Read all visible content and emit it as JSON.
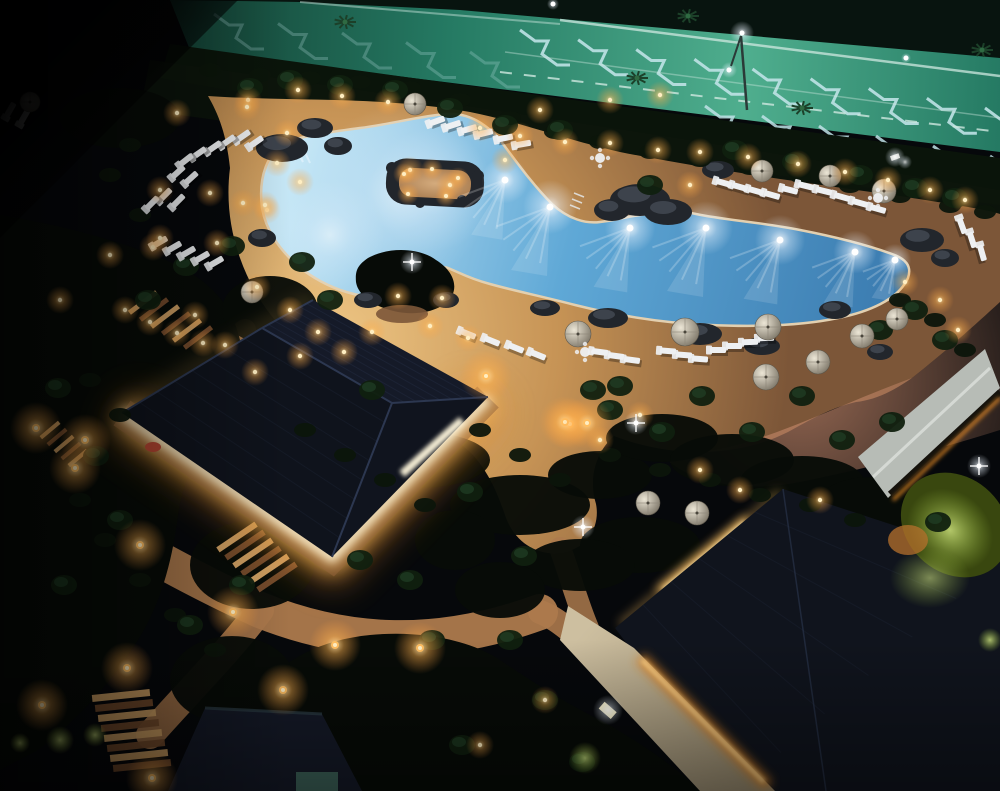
{
  "colors": {
    "night": "#06080b",
    "park_teal": "#257a63",
    "park_light": "#4fae8e",
    "park_dark": "#123c30",
    "park_road": "#08140f",
    "marking": "#bfe2e6",
    "rail": "#cfe8e0",
    "hedge": "#0a140a",
    "bush": "#0c150b",
    "tree": "#10200f",
    "tree_hi": "#23442a",
    "veg": "#070b07",
    "deck": "#c69355",
    "deck_bright": "#eec684",
    "deck_dim": "#7c5638",
    "deck_pink": "#c5886a",
    "water_deep": "#3878ad",
    "water_mid": "#5fa8d6",
    "water_pale": "#c6e7f6",
    "coping": "#e3d0b0",
    "sand": "#d4ab7d",
    "rock": "#454b55",
    "rock_dark": "#22262c",
    "roof": "#151a28",
    "roof_hi": "#1f2940",
    "roof_dark": "#10141d",
    "roof_line": "#2c3750",
    "glow_core": "#fff6d8",
    "glow_warm": "#f6bc62",
    "glow_amber": "#dd8526",
    "gravel": "#94653a",
    "path": "#ad7a4d",
    "stair_light": "#d9a868",
    "stair_dark": "#7a4f2e",
    "lamp": "#ffbe62",
    "lamp_core": "#ffeec2",
    "chair": "#eef0f2",
    "umb": "#cfc8b8",
    "umb_dark": "#7b7466",
    "walkway": "#c3b395",
    "grey_roof": "#b7bcb6",
    "green_lit": "#a9c348",
    "green_dark": "#39470f",
    "red": "#b24531",
    "white": "#ffffff"
  },
  "scene": {
    "parking": {
      "chevron_bands": [
        {
          "x0": 520,
          "y0": 30,
          "x1": 985,
          "y1": 108,
          "n": 9,
          "o": 0.9
        },
        {
          "x0": 705,
          "y0": 106,
          "x1": 990,
          "y1": 156,
          "n": 6,
          "o": 0.85
        },
        {
          "x0": 214,
          "y0": 14,
          "x1": 470,
          "y1": 52,
          "n": 5,
          "o": 0.25
        }
      ],
      "lines": [
        {
          "x1": 560,
          "y1": 20,
          "x2": 1000,
          "y2": 76,
          "w": 2.5,
          "o": 0.75,
          "dash": ""
        },
        {
          "x1": 300,
          "y1": 2,
          "x2": 560,
          "y2": 24,
          "w": 2,
          "o": 0.45,
          "dash": ""
        },
        {
          "x1": 500,
          "y1": 72,
          "x2": 1000,
          "y2": 132,
          "w": 2,
          "o": 0.8,
          "dash": "12 12"
        },
        {
          "x1": 505,
          "y1": 52,
          "x2": 1000,
          "y2": 118,
          "w": 1.5,
          "o": 0.4,
          "dash": ""
        }
      ]
    },
    "palms": [
      [
        637,
        78
      ],
      [
        802,
        108
      ],
      [
        982,
        50
      ],
      [
        345,
        22
      ],
      [
        688,
        16
      ]
    ],
    "street_lights": [
      [
        742,
        33,
        12
      ],
      [
        729,
        70,
        8
      ],
      [
        553,
        4,
        6
      ],
      [
        906,
        58,
        5
      ]
    ],
    "floodlight": [
      897,
      158
    ],
    "trees": [
      [
        58,
        388
      ],
      [
        96,
        456
      ],
      [
        148,
        300
      ],
      [
        186,
        266
      ],
      [
        232,
        246
      ],
      [
        330,
        300
      ],
      [
        372,
        390
      ],
      [
        302,
        262
      ],
      [
        120,
        520
      ],
      [
        64,
        585
      ],
      [
        190,
        625
      ],
      [
        242,
        585
      ],
      [
        470,
        492
      ],
      [
        524,
        556
      ],
      [
        432,
        640
      ],
      [
        620,
        386
      ],
      [
        662,
        432
      ],
      [
        702,
        396
      ],
      [
        752,
        432
      ],
      [
        802,
        396
      ],
      [
        842,
        440
      ],
      [
        892,
        422
      ],
      [
        938,
        522
      ],
      [
        582,
        762
      ],
      [
        545,
        700
      ],
      [
        462,
        745
      ],
      [
        510,
        640
      ],
      [
        360,
        560
      ],
      [
        410,
        580
      ],
      [
        650,
        185
      ],
      [
        560,
        130
      ],
      [
        505,
        125
      ],
      [
        450,
        108
      ],
      [
        395,
        90
      ],
      [
        340,
        85
      ],
      [
        290,
        80
      ],
      [
        250,
        88
      ],
      [
        735,
        150
      ],
      [
        795,
        162
      ],
      [
        860,
        175
      ],
      [
        915,
        188
      ],
      [
        955,
        198
      ],
      [
        880,
        330
      ],
      [
        915,
        310
      ],
      [
        945,
        340
      ],
      [
        593,
        390
      ],
      [
        610,
        410
      ]
    ],
    "bushes": [
      [
        210,
        70
      ],
      [
        260,
        75
      ],
      [
        310,
        78
      ],
      [
        360,
        82
      ],
      [
        410,
        88
      ],
      [
        460,
        100
      ],
      [
        510,
        118
      ],
      [
        555,
        132
      ],
      [
        600,
        142
      ],
      [
        650,
        152
      ],
      [
        700,
        160
      ],
      [
        750,
        168
      ],
      [
        800,
        176
      ],
      [
        850,
        186
      ],
      [
        900,
        196
      ],
      [
        950,
        206
      ],
      [
        985,
        212
      ],
      [
        90,
        380
      ],
      [
        120,
        415
      ],
      [
        80,
        500
      ],
      [
        105,
        540
      ],
      [
        140,
        580
      ],
      [
        175,
        615
      ],
      [
        215,
        650
      ],
      [
        480,
        430
      ],
      [
        520,
        455
      ],
      [
        560,
        480
      ],
      [
        610,
        455
      ],
      [
        660,
        470
      ],
      [
        710,
        480
      ],
      [
        760,
        495
      ],
      [
        810,
        505
      ],
      [
        855,
        520
      ],
      [
        305,
        430
      ],
      [
        345,
        455
      ],
      [
        385,
        480
      ],
      [
        425,
        505
      ],
      [
        900,
        300
      ],
      [
        935,
        320
      ],
      [
        965,
        350
      ],
      [
        130,
        145
      ],
      [
        110,
        175
      ],
      [
        140,
        215
      ]
    ],
    "veg_blobs": [
      [
        320,
        415,
        62,
        26
      ],
      [
        420,
        460,
        70,
        28
      ],
      [
        520,
        505,
        70,
        30
      ],
      [
        600,
        475,
        52,
        24
      ],
      [
        662,
        438,
        56,
        24
      ],
      [
        732,
        460,
        62,
        26
      ],
      [
        802,
        482,
        62,
        26
      ],
      [
        872,
        505,
        56,
        28
      ],
      [
        940,
        545,
        50,
        28
      ],
      [
        640,
        545,
        60,
        28
      ],
      [
        580,
        565,
        55,
        26
      ],
      [
        270,
        310,
        48,
        34
      ],
      [
        262,
        430,
        58,
        44
      ],
      [
        252,
        565,
        62,
        44
      ],
      [
        232,
        680,
        62,
        44
      ],
      [
        455,
        540,
        40,
        30
      ],
      [
        500,
        590,
        45,
        28
      ],
      [
        120,
        118,
        60,
        30
      ]
    ],
    "rocks": [
      [
        282,
        148,
        26,
        14
      ],
      [
        262,
        238,
        14,
        9
      ],
      [
        640,
        200,
        30,
        16
      ],
      [
        668,
        212,
        24,
        13
      ],
      [
        612,
        210,
        18,
        11
      ],
      [
        718,
        170,
        16,
        9
      ],
      [
        922,
        240,
        22,
        12
      ],
      [
        945,
        258,
        14,
        9
      ],
      [
        608,
        318,
        20,
        10
      ],
      [
        700,
        334,
        22,
        11
      ],
      [
        762,
        346,
        18,
        9
      ],
      [
        545,
        308,
        15,
        8
      ],
      [
        880,
        352,
        13,
        8
      ],
      [
        368,
        300,
        14,
        8
      ],
      [
        446,
        300,
        13,
        8
      ],
      [
        835,
        310,
        16,
        9
      ],
      [
        315,
        128,
        18,
        10
      ],
      [
        338,
        146,
        14,
        9
      ]
    ],
    "pool_lights": [
      [
        505,
        180,
        26
      ],
      [
        550,
        207,
        30
      ],
      [
        630,
        228,
        28
      ],
      [
        706,
        228,
        30
      ],
      [
        780,
        240,
        28
      ],
      [
        855,
        252,
        24
      ],
      [
        895,
        260,
        18
      ]
    ],
    "pool_soft_glows": [
      [
        400,
        195,
        90
      ],
      [
        330,
        235,
        55
      ],
      [
        432,
        190,
        62
      ]
    ],
    "island_lights": [
      [
        404,
        174
      ],
      [
        432,
        169
      ],
      [
        458,
        178
      ],
      [
        446,
        196
      ],
      [
        408,
        194
      ]
    ],
    "chairs": [
      [
        243,
        136,
        -35
      ],
      [
        256,
        142,
        -35
      ],
      [
        228,
        141,
        -35
      ],
      [
        214,
        147,
        -35
      ],
      [
        199,
        153,
        -35
      ],
      [
        186,
        160,
        -38
      ],
      [
        178,
        172,
        -42
      ],
      [
        191,
        178,
        -42
      ],
      [
        165,
        195,
        -45
      ],
      [
        178,
        201,
        -45
      ],
      [
        152,
        203,
        -45
      ],
      [
        160,
        242,
        -30
      ],
      [
        174,
        247,
        -30
      ],
      [
        188,
        252,
        -30
      ],
      [
        202,
        257,
        -30
      ],
      [
        216,
        262,
        -30
      ],
      [
        10,
        110,
        -60
      ],
      [
        24,
        117,
        -60
      ],
      [
        437,
        121,
        -20
      ],
      [
        453,
        125,
        -18
      ],
      [
        469,
        129,
        -16
      ],
      [
        485,
        133,
        -14
      ],
      [
        505,
        138,
        -12
      ],
      [
        523,
        144,
        -10
      ],
      [
        724,
        183,
        16
      ],
      [
        740,
        187,
        16
      ],
      [
        756,
        191,
        16
      ],
      [
        772,
        195,
        16
      ],
      [
        790,
        190,
        14
      ],
      [
        806,
        186,
        14
      ],
      [
        824,
        191,
        14
      ],
      [
        842,
        197,
        16
      ],
      [
        860,
        203,
        16
      ],
      [
        878,
        209,
        16
      ],
      [
        962,
        226,
        70
      ],
      [
        972,
        240,
        72
      ],
      [
        982,
        253,
        74
      ],
      [
        600,
        352,
        8
      ],
      [
        616,
        356,
        8
      ],
      [
        632,
        360,
        8
      ],
      [
        668,
        351,
        4
      ],
      [
        684,
        355,
        4
      ],
      [
        700,
        359,
        4
      ],
      [
        718,
        350,
        0
      ],
      [
        734,
        346,
        0
      ],
      [
        750,
        342,
        -2
      ],
      [
        766,
        338,
        -2
      ],
      [
        468,
        334,
        22
      ],
      [
        492,
        341,
        22
      ],
      [
        516,
        348,
        22
      ],
      [
        538,
        355,
        22
      ]
    ],
    "umbrellas": [
      [
        415,
        104,
        11
      ],
      [
        30,
        102,
        10
      ],
      [
        252,
        292,
        11
      ],
      [
        762,
        171,
        11
      ],
      [
        830,
        176,
        11
      ],
      [
        884,
        191,
        12
      ],
      [
        578,
        334,
        13
      ],
      [
        685,
        332,
        14
      ],
      [
        768,
        327,
        13
      ],
      [
        766,
        377,
        13
      ],
      [
        818,
        362,
        12
      ],
      [
        862,
        336,
        12
      ],
      [
        897,
        319,
        11
      ],
      [
        648,
        503,
        12
      ],
      [
        697,
        513,
        12
      ]
    ],
    "tables": [
      [
        600,
        158
      ],
      [
        585,
        352
      ],
      [
        878,
        198
      ]
    ],
    "path_lights": [
      [
        85,
        440
      ],
      [
        140,
        545
      ],
      [
        233,
        612
      ],
      [
        127,
        668
      ],
      [
        42,
        705
      ],
      [
        283,
        690
      ],
      [
        335,
        645
      ],
      [
        570,
        424
      ],
      [
        36,
        428
      ],
      [
        75,
        468
      ],
      [
        152,
        778
      ],
      [
        420,
        648
      ],
      [
        486,
        376
      ],
      [
        565,
        422
      ],
      [
        587,
        423
      ]
    ],
    "hedge_lights": [
      [
        248,
        100
      ],
      [
        298,
        90
      ],
      [
        342,
        96
      ],
      [
        388,
        102
      ],
      [
        177,
        113
      ],
      [
        247,
        107
      ],
      [
        287,
        133
      ],
      [
        277,
        163
      ],
      [
        210,
        193
      ],
      [
        160,
        190
      ],
      [
        267,
        210
      ],
      [
        243,
        203
      ],
      [
        217,
        243
      ],
      [
        153,
        247
      ],
      [
        257,
        287
      ],
      [
        300,
        182
      ],
      [
        265,
        205
      ],
      [
        160,
        238
      ],
      [
        110,
        255
      ],
      [
        60,
        300
      ],
      [
        480,
        128
      ],
      [
        520,
        136
      ],
      [
        565,
        142
      ],
      [
        610,
        143
      ],
      [
        658,
        150
      ],
      [
        700,
        152
      ],
      [
        748,
        157
      ],
      [
        798,
        164
      ],
      [
        845,
        172
      ],
      [
        888,
        180
      ],
      [
        930,
        190
      ],
      [
        965,
        200
      ],
      [
        290,
        310
      ],
      [
        318,
        332
      ],
      [
        344,
        352
      ],
      [
        372,
        332
      ],
      [
        300,
        356
      ],
      [
        430,
        326
      ],
      [
        468,
        338
      ],
      [
        905,
        282
      ],
      [
        940,
        300
      ],
      [
        958,
        330
      ],
      [
        700,
        470
      ],
      [
        740,
        490
      ],
      [
        820,
        500
      ],
      [
        640,
        415
      ],
      [
        600,
        440
      ],
      [
        545,
        700
      ],
      [
        480,
        745
      ],
      [
        660,
        95
      ],
      [
        610,
        100
      ],
      [
        540,
        110
      ],
      [
        410,
        170
      ],
      [
        450,
        185
      ],
      [
        505,
        160
      ],
      [
        690,
        185
      ],
      [
        195,
        315
      ],
      [
        225,
        345
      ],
      [
        255,
        372
      ],
      [
        398,
        296
      ],
      [
        442,
        298
      ],
      [
        125,
        310
      ],
      [
        150,
        322
      ],
      [
        177,
        333
      ],
      [
        203,
        343
      ]
    ],
    "lit_bushes": [
      [
        585,
        758,
        16
      ],
      [
        60,
        740,
        14
      ],
      [
        95,
        735,
        12
      ],
      [
        990,
        640,
        12
      ],
      [
        20,
        743,
        10
      ]
    ],
    "sparkles": [
      [
        583,
        527
      ],
      [
        636,
        423
      ],
      [
        979,
        466
      ],
      [
        412,
        262
      ]
    ],
    "stairs": [
      {
        "x": 92,
        "y": 692,
        "n": 8,
        "w": 58,
        "h": 7,
        "dx": 3,
        "dy": 10,
        "rot": -6
      },
      {
        "x": 126,
        "y": 300,
        "n": 6,
        "w": 34,
        "h": 5,
        "dx": 11,
        "dy": 7,
        "rot": -37
      },
      {
        "x": 214,
        "y": 534,
        "n": 6,
        "w": 46,
        "h": 6,
        "dx": 8,
        "dy": 8,
        "rot": -34
      },
      {
        "x": 38,
        "y": 428,
        "n": 5,
        "w": 24,
        "h": 4,
        "dx": 7,
        "dy": 7,
        "rot": -40
      }
    ],
    "building": {
      "A": [
        122,
        413
      ],
      "B": [
        313,
        300
      ],
      "C": [
        488,
        397
      ],
      "D": [
        332,
        557
      ],
      "P1": [
        262,
        328
      ],
      "P2": [
        392,
        403
      ]
    },
    "br_roof": {
      "apex": [
        783,
        489
      ],
      "right": [
        1000,
        560
      ],
      "bl": [
        737,
        791
      ],
      "left": [
        615,
        628
      ]
    }
  }
}
